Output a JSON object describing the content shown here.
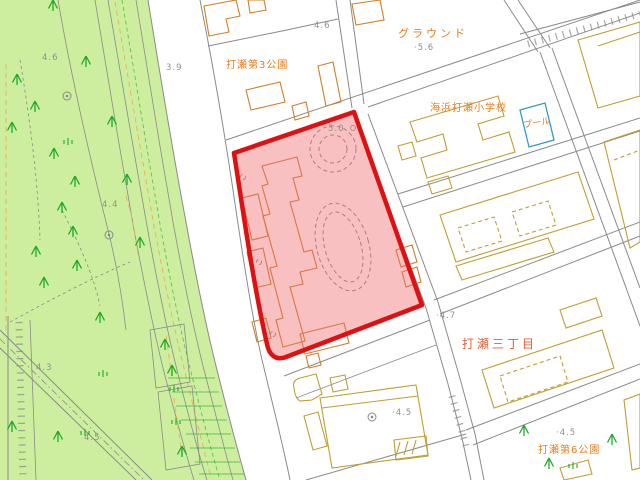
{
  "map": {
    "kind": "japanese-city-base-map",
    "labels": {
      "ground": {
        "text": "グラウンド"
      },
      "park3": {
        "text": "打瀬第3公園"
      },
      "school": {
        "text": "海浜打瀬小学校"
      },
      "pool": {
        "text": "プール"
      },
      "district": {
        "text": "打瀬三丁目"
      },
      "park6": {
        "text": "打瀬第6公園"
      }
    },
    "elevations": [
      {
        "text": "·5.6"
      },
      {
        "text": "4.6"
      },
      {
        "text": "3.9"
      },
      {
        "text": "4.6"
      },
      {
        "text": "5.0"
      },
      {
        "text": "4.4"
      },
      {
        "text": "4.3"
      },
      {
        "text": "4.5"
      },
      {
        "text": "·4.5"
      },
      {
        "text": "·4.5"
      },
      {
        "text": "·4.7"
      }
    ],
    "selection": {
      "description": "selected parcel highlighted in red"
    }
  },
  "colors": {
    "park_fill": "#cdee9f",
    "line_gray": "#8a8a8a",
    "elev_gray": "#8f8f8f",
    "bldg_orange": "#cf7f2a",
    "bldg_olive": "#bf9e33",
    "label_orange": "#e87d1a",
    "label_red": "#e25f35",
    "tree_green": "#1faa28",
    "pool_blue": "#3399cc",
    "path_orange": "#f0b060",
    "selection_red": "#dd1111",
    "selection_fill": "#ee6a6a"
  }
}
